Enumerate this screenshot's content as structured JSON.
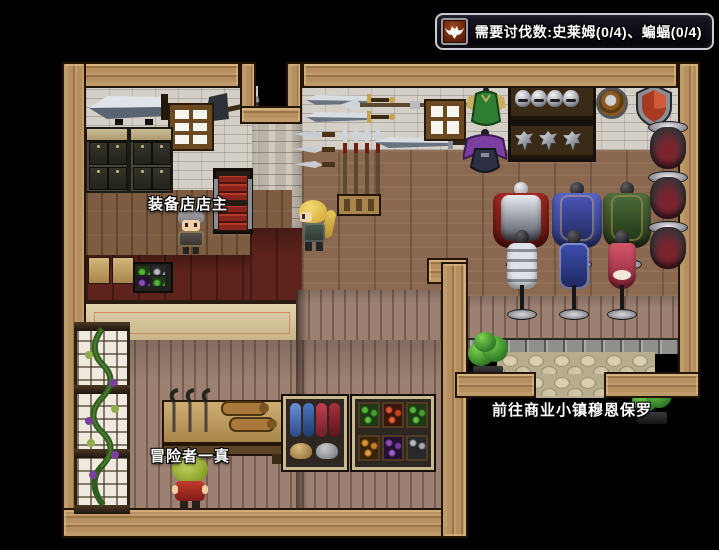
{
  "hud": {
    "quest_banner": {
      "icon": "bat-monster-icon",
      "text": "需要讨伐数:史莱姆(0/4)、蝙蝠(0/4)"
    }
  },
  "map": {
    "labels": {
      "shopkeeper": "装备店店主",
      "adventurer": "冒险者一真",
      "exit_hint": "前往商业小镇穆恩保罗"
    }
  },
  "colors": {
    "hud_border": "#c9cad2",
    "hud_bg": "#06060e",
    "hud_icon_bg": "#7c2b13",
    "frame_wood": "#b68f5f",
    "stone_wall": "#d4d0c8",
    "floor_wood": "#8b6951",
    "counter_top_red": "#5e231c",
    "counter_front_beige": "#d9c493",
    "plank_wall": "#9c8172",
    "shield_red": "#a93a22",
    "bush_green": "#3f8f2f"
  }
}
